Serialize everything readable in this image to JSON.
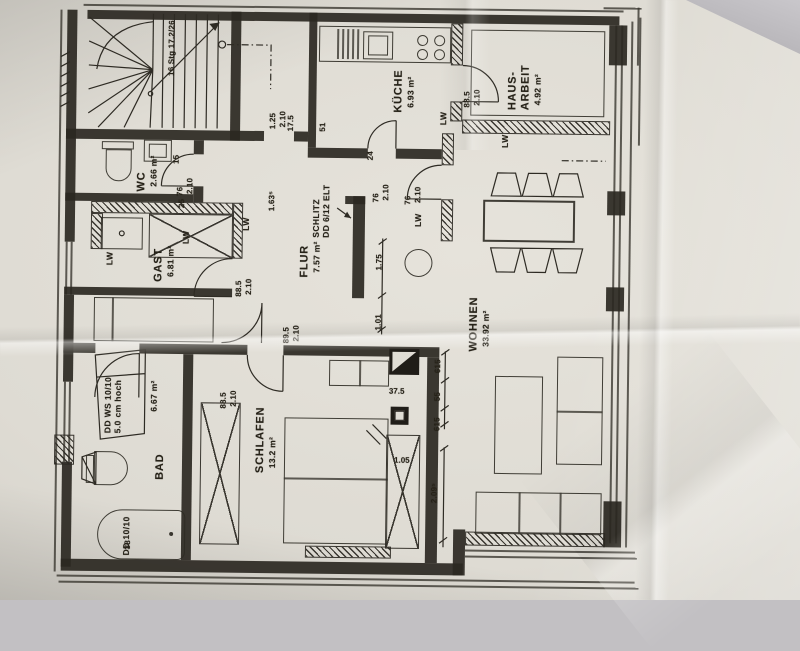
{
  "photo": {
    "background_color": "#c2c0c3",
    "paper_color": "#dfdcd4",
    "ink_color": "#2b2822"
  },
  "plan": {
    "stairs_label": "16 Stg 17.2/26",
    "rooms": [
      {
        "id": "wc",
        "name": "WC",
        "area": "2.66 m²"
      },
      {
        "id": "kueche",
        "name": "KÜCHE",
        "area": "6.93 m²"
      },
      {
        "id": "hausarbeit",
        "name": "HAUS-ARBEIT",
        "area": "4.92 m²"
      },
      {
        "id": "gast",
        "name": "GAST",
        "area": "6.81 m²"
      },
      {
        "id": "flur",
        "name": "FLUR",
        "area": "7.57 m²"
      },
      {
        "id": "wohnen",
        "name": "WOHNEN",
        "area": "33.92 m²"
      },
      {
        "id": "schlafen",
        "name": "SCHLAFEN",
        "area": "13.2 m²"
      },
      {
        "id": "bad",
        "name": "BAD",
        "area": "6.67 m²"
      }
    ],
    "annotations": {
      "schlitz_line1": "SCHLITZ",
      "schlitz_line2": "DD 6/12 ELT",
      "ddws_line1": "DD WS 10/10",
      "ddws_line2": "5.0 cm hoch",
      "dd1010": "DD 10/10",
      "tub_mark": "38",
      "lw": "LW"
    },
    "dimensions": {
      "door_wc_w": "76",
      "door_wc_h": "2.10",
      "door_kueche_w": "76",
      "door_kueche_h": "2.10",
      "door_wohnen_w": "76",
      "door_wohnen_h": "2.10",
      "door_hausarbeit_w": "88.5",
      "door_hausarbeit_h": "2.10",
      "door_gast_w": "88.5",
      "door_gast_h": "2.10",
      "door_bad_w": "89.5",
      "door_bad_h": "2.10",
      "door_schlafen_w": "88.5",
      "door_schlafen_h": "2.10",
      "opening_hall_w": "1.25",
      "opening_hall_h": "2.10",
      "flur_width": "1.75",
      "wohnen_opening": "1.01",
      "flur_upper": "1.63⁵",
      "schlafen_width": "2.09⁵",
      "pier_1": "615",
      "pier_2": "55",
      "pier_3": "615",
      "chimney_width": "37.5",
      "niche": "1.05",
      "wall_a": "24",
      "wall_b": "51",
      "wall_c": "17.5",
      "wall_d": "15",
      "wall_e": "25"
    }
  }
}
